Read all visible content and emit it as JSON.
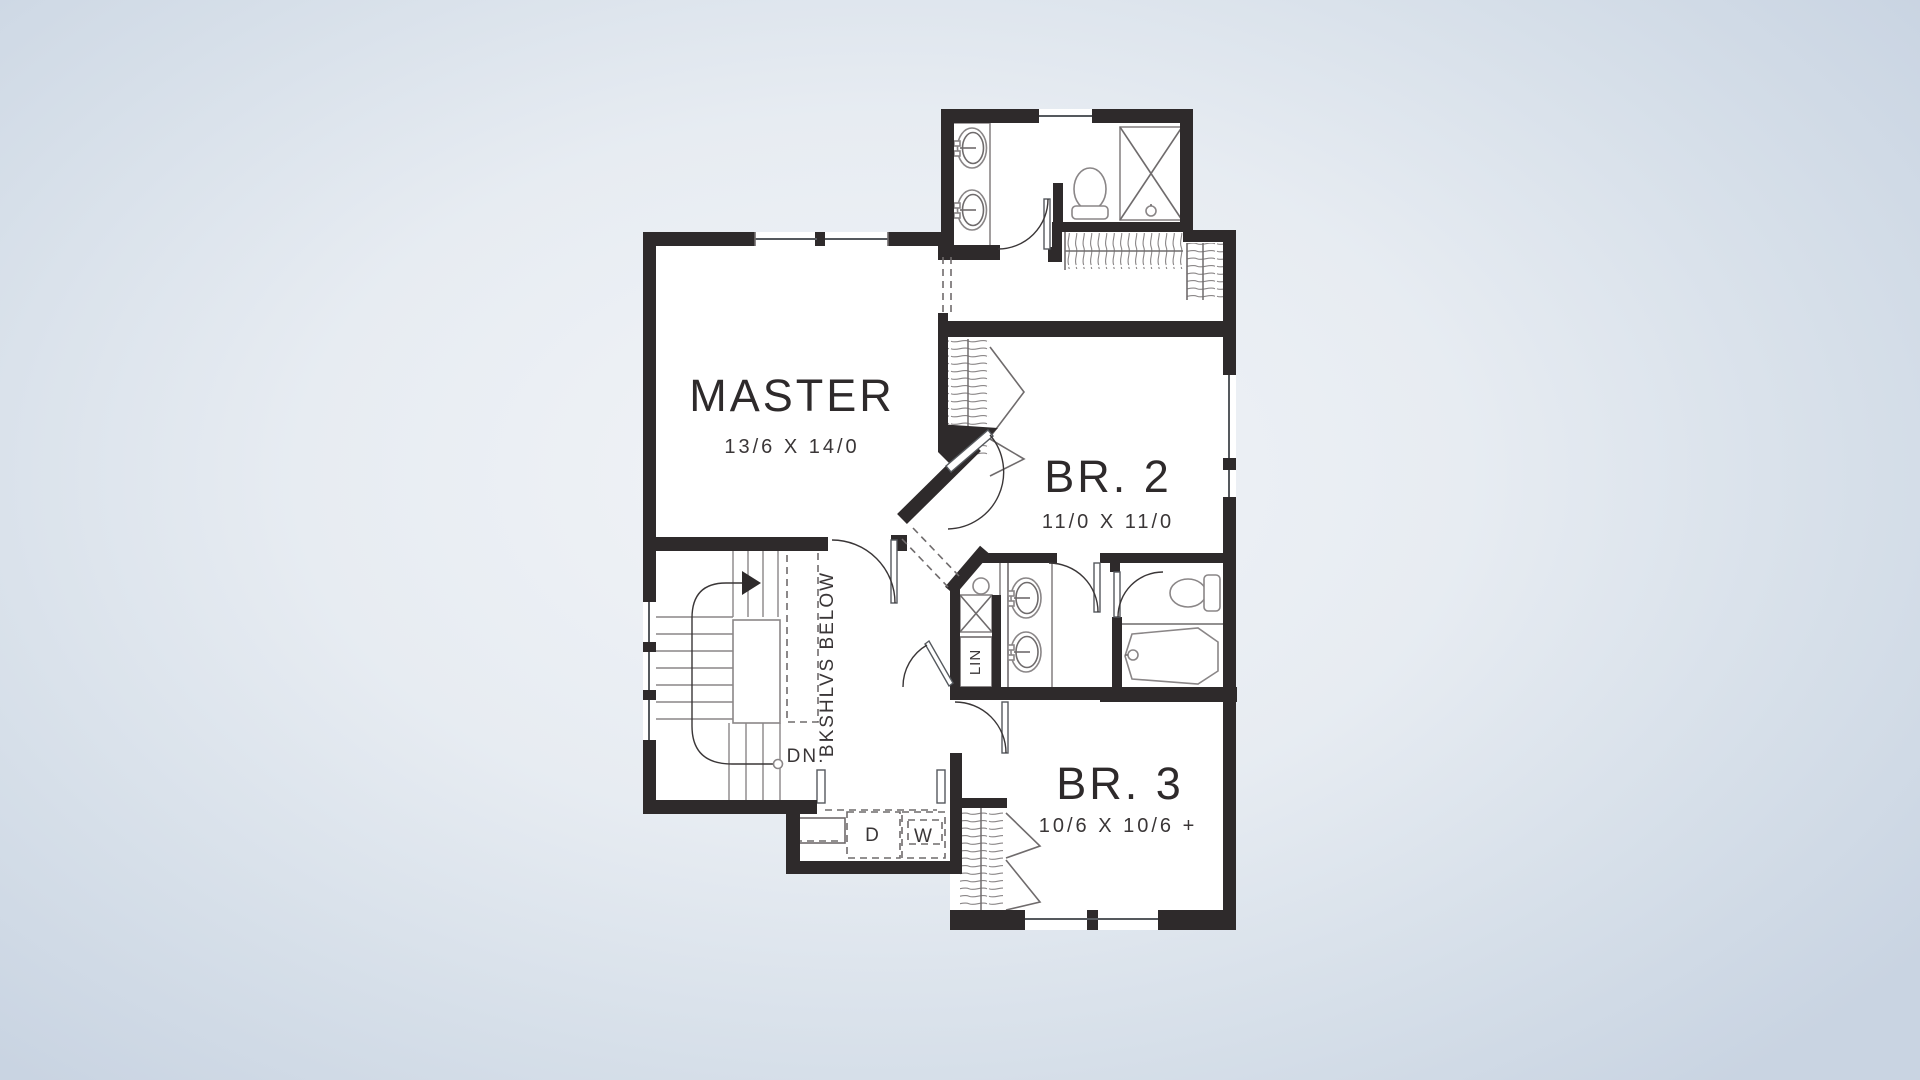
{
  "plan": {
    "colors": {
      "wall_ink": "#2e2a2b",
      "line": "#6f6b6c",
      "bg_center": "#f2f4f7",
      "bg_edge": "#c9d4e2"
    },
    "rooms": {
      "master": {
        "label": "MASTER",
        "dims": "13/6 X 14/0"
      },
      "br2": {
        "label": "BR. 2",
        "dims": "11/0 X 11/0"
      },
      "br3": {
        "label": "BR. 3",
        "dims": "10/6 X 10/6 +"
      }
    },
    "annotations": {
      "bookshelves": "BKSHLVS BELOW",
      "down": "DN.",
      "linen": "LIN",
      "dryer": "D",
      "washer": "W"
    }
  }
}
